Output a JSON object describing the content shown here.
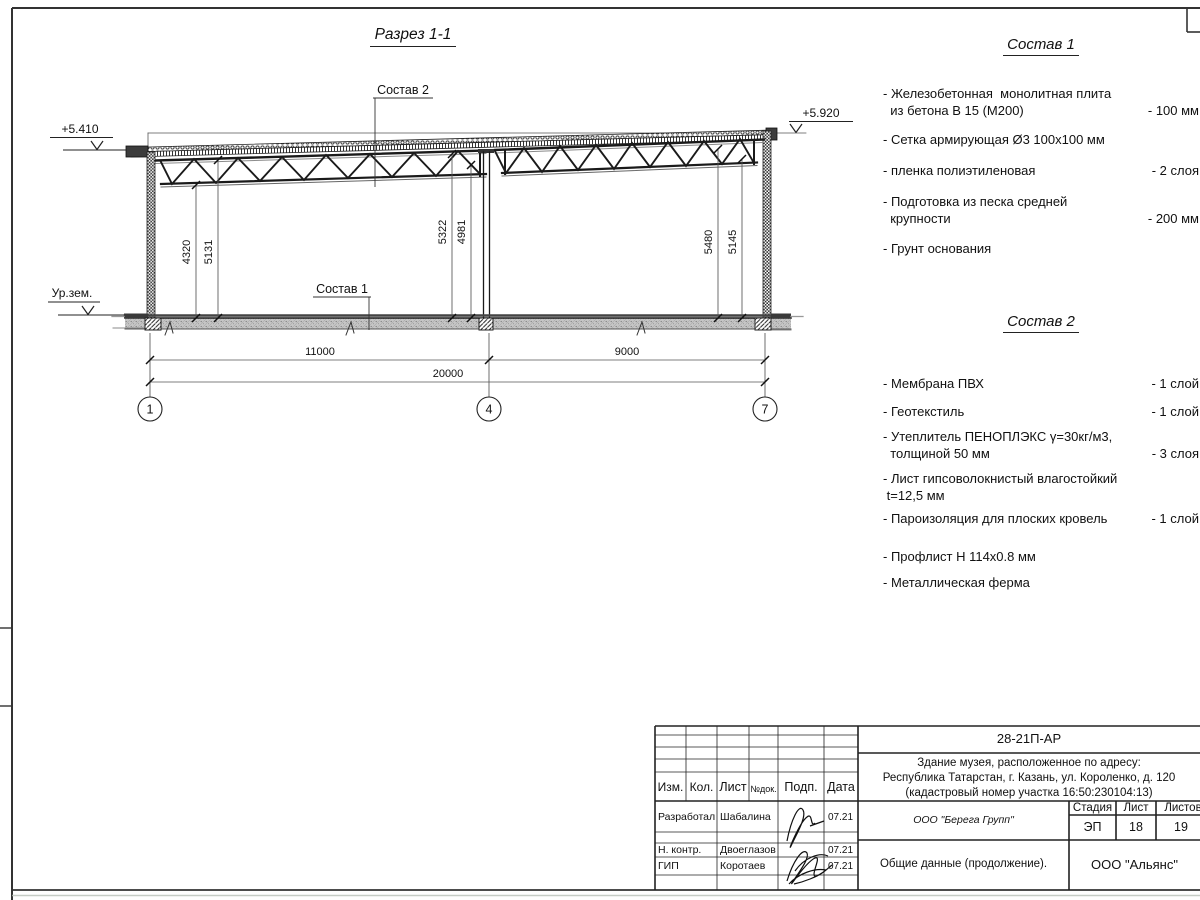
{
  "drawing": {
    "title": "Разрез 1-1",
    "callouts": {
      "sostav1": "Состав 1",
      "sostav2": "Состав 2"
    },
    "elevations": {
      "left": "+5.410",
      "right": "+5.920",
      "ground": "Ур.зем."
    },
    "vdims": {
      "d1": "4320",
      "d2": "5131",
      "d3": "5322",
      "d4": "4981",
      "d5": "5480",
      "d6": "5145"
    },
    "hdims": {
      "span1": "11000",
      "span2": "9000",
      "total": "20000"
    },
    "axes": {
      "a1": "1",
      "a2": "4",
      "a3": "7"
    }
  },
  "panels": {
    "sostav1": {
      "title": "Состав 1",
      "items": [
        {
          "text": "- Железобетонная  монолитная плита\n  из бетона В 15 (М200)",
          "value": "- 100 мм"
        },
        {
          "text": "- Сетка армирующая Ø3 100х100 мм",
          "value": ""
        },
        {
          "text": "- пленка полиэтиленовая",
          "value": "- 2  слоя"
        },
        {
          "text": "- Подготовка из песка средней\n  крупности",
          "value": "- 200 мм"
        },
        {
          "text": "- Грунт основания",
          "value": ""
        }
      ]
    },
    "sostav2": {
      "title": "Состав 2",
      "items": [
        {
          "text": "- Мембрана ПВХ",
          "value": "- 1 слой"
        },
        {
          "text": "- Геотекстиль",
          "value": "- 1 слой"
        },
        {
          "text": "- Утеплитель ПЕНОПЛЭКС γ=30кг/м3,\n  толщиной 50 мм",
          "value": "- 3 слоя"
        },
        {
          "text": "- Лист гипсоволокнистый влагостойкий\n t=12,5 мм",
          "value": ""
        },
        {
          "text": "- Пароизоляция для плоских кровель",
          "value": "- 1 слой"
        },
        {
          "text": "- Профлист Н 114х0.8 мм",
          "value": ""
        },
        {
          "text": "- Металлическая ферма",
          "value": ""
        }
      ]
    }
  },
  "titleblock": {
    "code": "28-21П-АР",
    "object_description": "Здание музея, расположенное по адресу:\nРеспублика Татарстан, г. Казань, ул. Короленко, д. 120\n(кадастровый номер участка 16:50:230104:13)",
    "columns": {
      "izm": "Изм.",
      "kol": "Кол.",
      "list": "Лист",
      "ndok": "№док.",
      "podp": "Подп.",
      "data": "Дата"
    },
    "rows": [
      {
        "role": "Разработал",
        "name": "Шабалина",
        "date": "07.21"
      },
      {
        "role": "Н. контр.",
        "name": "Двоеглазов",
        "date": "07.21"
      },
      {
        "role": "ГИП",
        "name": "Коротаев",
        "date": "07.21"
      }
    ],
    "org_contractor": "ООО \"Берега Групп\"",
    "stage_label": "Стадия",
    "sheet_label": "Лист",
    "sheets_label": "Листов",
    "stage": "ЭП",
    "sheet": "18",
    "sheets": "19",
    "doc_title": "Общие данные (продолжение).",
    "org": "ООО \"Альянс\""
  }
}
